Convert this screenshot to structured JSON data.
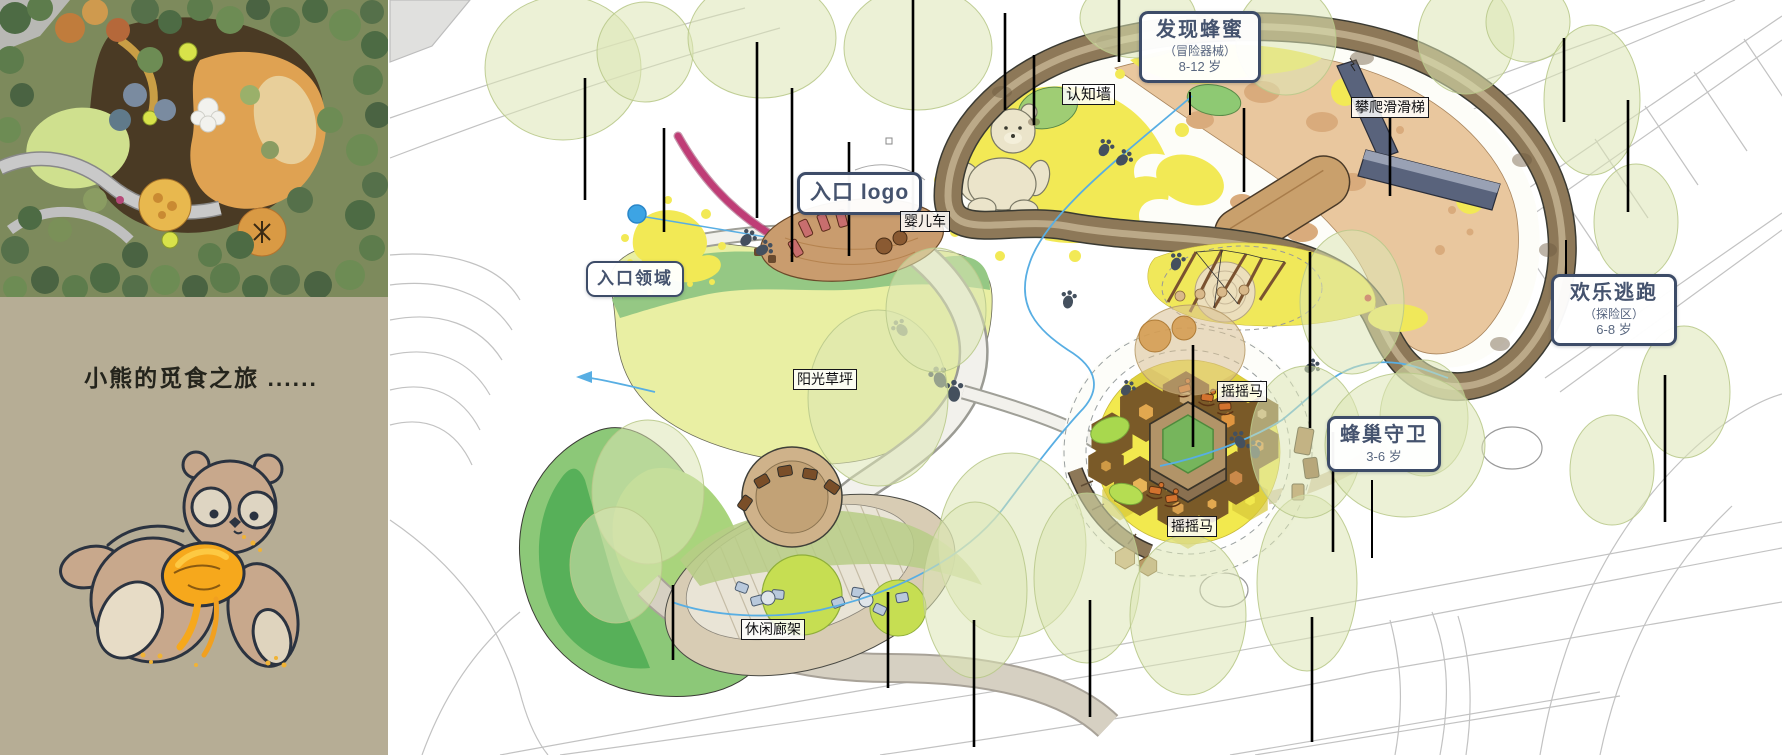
{
  "left_panel": {
    "caption": "小熊的觅食之旅 ......"
  },
  "callouts": {
    "discover_honey": {
      "title": "发现蜂蜜",
      "subtitle": "（冒险器械）",
      "age": "8-12 岁"
    },
    "happy_escape": {
      "title": "欢乐逃跑",
      "subtitle": "（探险区）",
      "age": "6-8 岁"
    },
    "beehive_guard": {
      "title": "蜂巢守卫",
      "age": "3-6 岁"
    },
    "entrance_logo": {
      "title": "入口 logo"
    },
    "entrance_area": {
      "title": "入口领域"
    }
  },
  "tags": {
    "cognition_wall": "认知墙",
    "climbing_slide": "攀爬滑滑梯",
    "stroller": "婴儿车",
    "sunny_lawn": "阳光草坪",
    "rocking_horse_upper": "摇摇马",
    "rocking_horse_lower": "摇摇马",
    "leisure_pergola": "休闲廊架"
  },
  "colors": {
    "panel_beige": "#b6ad95",
    "callout_border": "#3d4c68",
    "callout_text": "#45536e",
    "tag_border": "#15151a",
    "tree_green": "#dce6b4",
    "ground_yellow": "#f2e955",
    "ring_brown": "#8d7858",
    "lawn_green": "#e9efa3",
    "stream_blue": "#58aee3",
    "entrance_magenta": "#bf3d76",
    "honey_orange": "#f6a81c"
  },
  "icons": {
    "paw_print_icon": "bear paw print (ellipse pad + 3 toe dots)",
    "tree_canopy_icon": "translucent green ellipse with stake line",
    "rocking_horse_icon": "small orange rocker",
    "bear_sculpture_icon": "cream teddy-bear ground sculpture",
    "bear_mascot_icon": "brown cartoon bear eating honey"
  }
}
